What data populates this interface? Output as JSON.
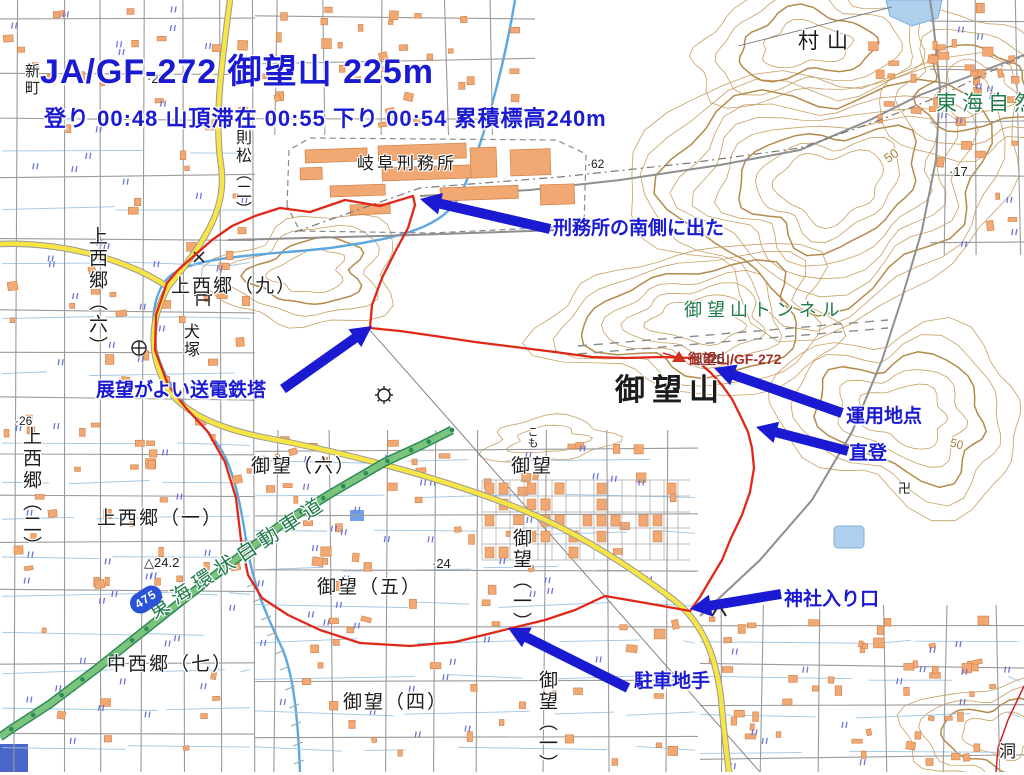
{
  "header": {
    "title": "JA/GF-272 御望山 225m",
    "stats": "登り 00:48 山頂滞在 00:55 下り 00:54 累積標高240m"
  },
  "annotations": {
    "prison_exit": "刑務所の南側に出た",
    "pylon_view": "展望がよい送電鉄塔",
    "operating_point": "運用地点",
    "direct_climb": "直登",
    "shrine_entrance": "神社入り口",
    "parking": "駐車地手"
  },
  "map_labels": {
    "murayama": "村山",
    "tokai_trail": "東海自然歩道",
    "gifu_prison": "岐阜刑務所",
    "shinmachi": "新町",
    "norimatsu_2": "則松（二）",
    "kaminishigo_9": "上西郷（九）",
    "kaminishigo_6": "上西郷（六）",
    "kaminishigo_2": "上西郷（二）",
    "kaminishigo_1": "上西郷（一）",
    "nakanishigo_7": "中西郷（七）",
    "inuzuka": "犬塚",
    "gomo_6": "御望（六）",
    "gomo": "御望",
    "gomo_5": "御望（五）",
    "gomo_4": "御望（四）",
    "gomo_1a": "御望（一）",
    "gomo_1b": "御望（一）",
    "komo": "こも",
    "tunnel": "御望山トンネル",
    "mountain": "御望山",
    "expressway": "東海環状自動車道",
    "hora": "洞"
  },
  "markers": {
    "summit_triangulation": "△225",
    "summit_sota": "御望山/GF-272",
    "route_shield": "475",
    "temple_swastika": "卍",
    "spot_62": "·62",
    "spot_17": "·17",
    "spot_29": "·29",
    "spot_26": "·26",
    "spot_24": "·24",
    "tri_242": "△24.2",
    "contour_50a": "50",
    "contour_50b": "50"
  },
  "colors": {
    "annotation_blue": "#1a1ad2",
    "track_red": "#e02818",
    "summit_red_text": "#a33028",
    "map_green_text": "#1e7a4a",
    "highway_green_fill": "#7cc47e",
    "highway_green_edge": "#2e8b57",
    "road_yellow_fill": "#f6e545",
    "road_casing": "#999999",
    "contour_brown": "#c49a58",
    "contour_index_brown": "#b08440",
    "building_orange": "#f2a873",
    "building_edge": "#cf8048",
    "water_blue": "#5ba7e0",
    "paddy_blue": "#6b74d8",
    "street_gray": "#9b9b9b",
    "dash_gray": "#8a8a8a"
  }
}
